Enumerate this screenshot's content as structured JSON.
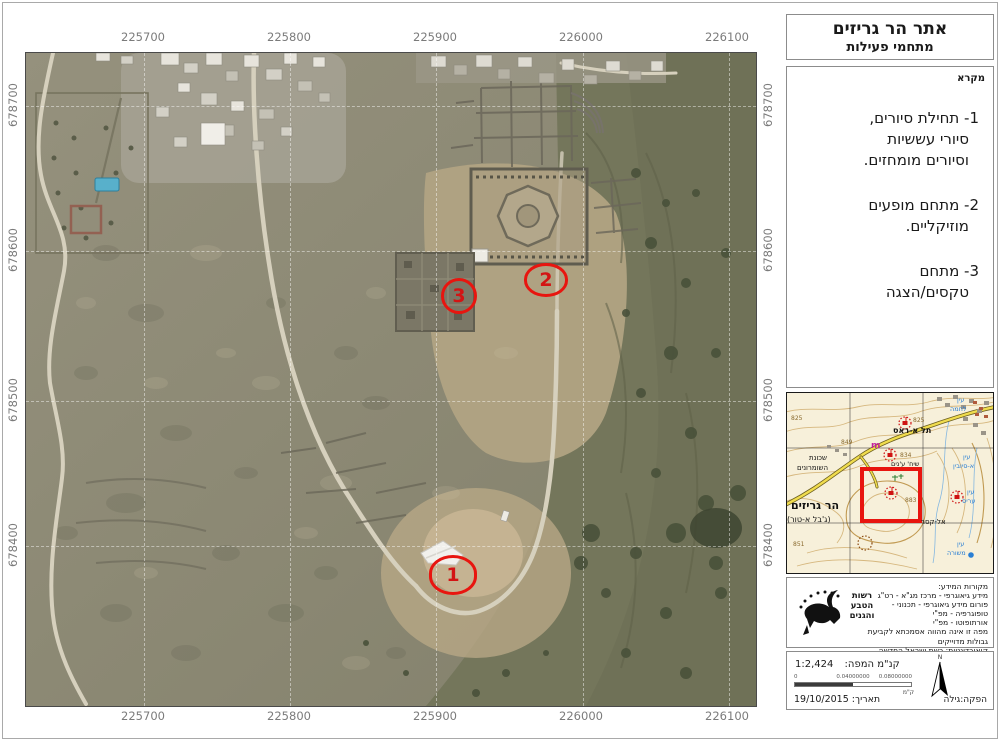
{
  "colors": {
    "marker_red": "#e8150f",
    "inset_highlight_red": "#e8150f",
    "spring_blue": "#2a7fd4",
    "road_yellow": "#f0dc4e"
  },
  "title": {
    "line1": "אתר הר גריזים",
    "line2": "מתחמי פעילות"
  },
  "legend": {
    "header": "מקרא",
    "items": [
      {
        "lines": [
          "1- תחילת סיורים,",
          "סיורי עששיות",
          "וסיורים מומחזים."
        ]
      },
      {
        "lines": [
          "2- מתחם מופעים",
          "מוזיקליים."
        ]
      },
      {
        "lines": [
          "3- מתחם",
          "טקסים/הצגה"
        ]
      }
    ]
  },
  "map": {
    "x_labels": [
      "225700",
      "225800",
      "225900",
      "226000",
      "226100"
    ],
    "y_labels": [
      "678700",
      "678600",
      "678500",
      "678400"
    ],
    "markers": [
      {
        "number": "1"
      },
      {
        "number": "2"
      },
      {
        "number": "3"
      }
    ]
  },
  "inset": {
    "labels": {
      "tel_a_ras": "תל א-ראס",
      "sheikh": "שיח' ע'נים",
      "neighborhood_1": "שכונת",
      "neighborhood_2": "השומרונים",
      "har_gerizim": "הר גריזים",
      "jabal_a_tur": "(ג'בל א-טור)",
      "el_qasr": "אל-קסר",
      "ein": "עין",
      "ein_lahma": "לחמה",
      "ein_a_subyin": "א-סיובין",
      "ein_aris": "עריס",
      "ein_mashura": "משורה",
      "m_symbol": "m",
      "elev_825": "825",
      "elev_849": "849",
      "elev_834": "834",
      "elev_883": "883",
      "elev_851": "851"
    }
  },
  "credits": {
    "logo_lines": [
      "רשות",
      "הטבע",
      "והגנים"
    ],
    "lines": [
      "מקורות המידע:",
      "מידע גיאוגרפי - מרכז מג\"א - רט\"ג",
      "פורום מידע גיאוגרפי - תכנוני -",
      "טופוגרפיה - מפ\"י",
      "אורתופוטו - מפ\"י",
      "מפה זו אינה מהווה אסמכתא לקביעת גבולות מדוייקים",
      "קואורדינטות: רשת ישראל החדשה"
    ]
  },
  "scalebox": {
    "scale_label": "קנ\"מ המפה:",
    "scale_value": "1:2,424",
    "ticks": [
      "0",
      "0.04000000",
      "0.08000000"
    ],
    "unit": "ק\"מ",
    "north": "N",
    "date": "תאריך: 19/10/2015",
    "producer": "הפקה:גילה"
  }
}
